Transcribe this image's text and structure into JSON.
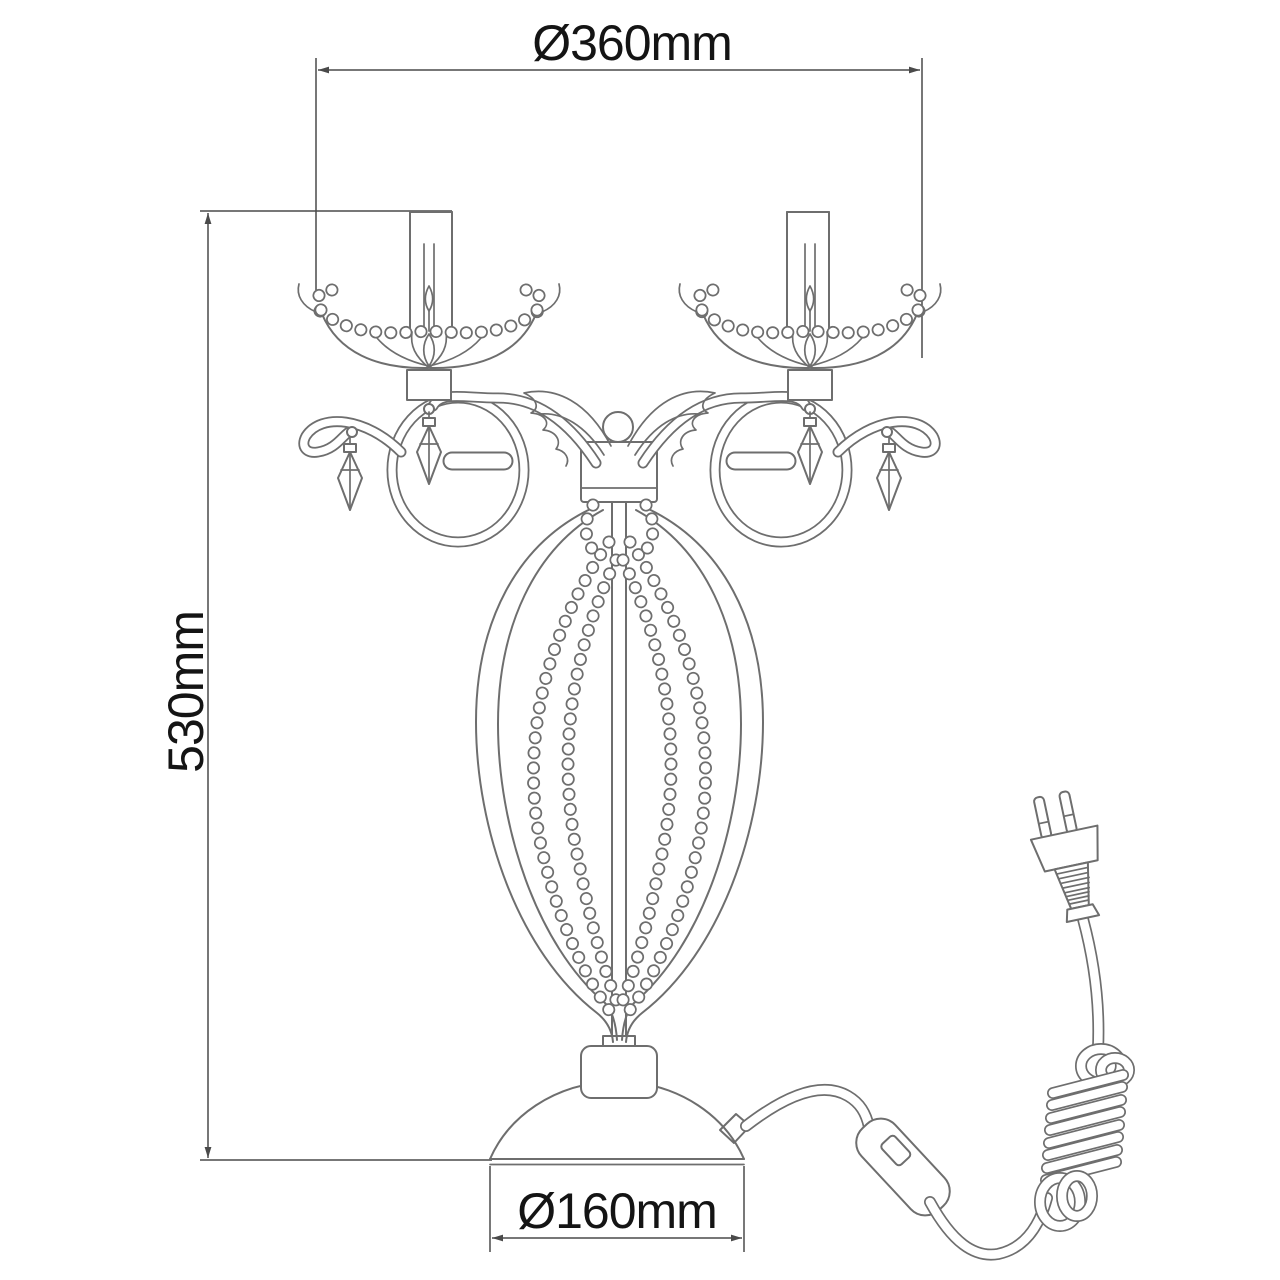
{
  "page": {
    "background": "#ffffff"
  },
  "drawing": {
    "name": "crystal-table-lamp-dimension-drawing",
    "dimensions": [
      {
        "id": "top_width",
        "label": "Ø360mm",
        "value": 360,
        "unit": "mm",
        "orientation": "horizontal",
        "position": "top"
      },
      {
        "id": "left_height",
        "label": "530mm",
        "value": 530,
        "unit": "mm",
        "orientation": "vertical",
        "position": "left"
      },
      {
        "id": "base_diameter",
        "label": "Ø160mm",
        "value": 160,
        "unit": "mm",
        "orientation": "horizontal",
        "position": "bottom"
      }
    ],
    "colors": {
      "background": "#ffffff",
      "drawing_line": "#6e6e6e",
      "dimension_line": "#4a4a4a",
      "text": "#141414"
    },
    "parts": [
      "candle-sleeve-left",
      "candle-sleeve-right",
      "bobeche-left",
      "bobeche-right",
      "bead-garland",
      "crystal-drop-pendants",
      "scroll-arm-left",
      "scroll-arm-right",
      "center-finial-ball",
      "center-hub-block",
      "center-column",
      "beaded-body-cage",
      "body-frame",
      "dome-base",
      "power-cord",
      "inline-switch",
      "cord-coil",
      "euro-plug"
    ]
  }
}
